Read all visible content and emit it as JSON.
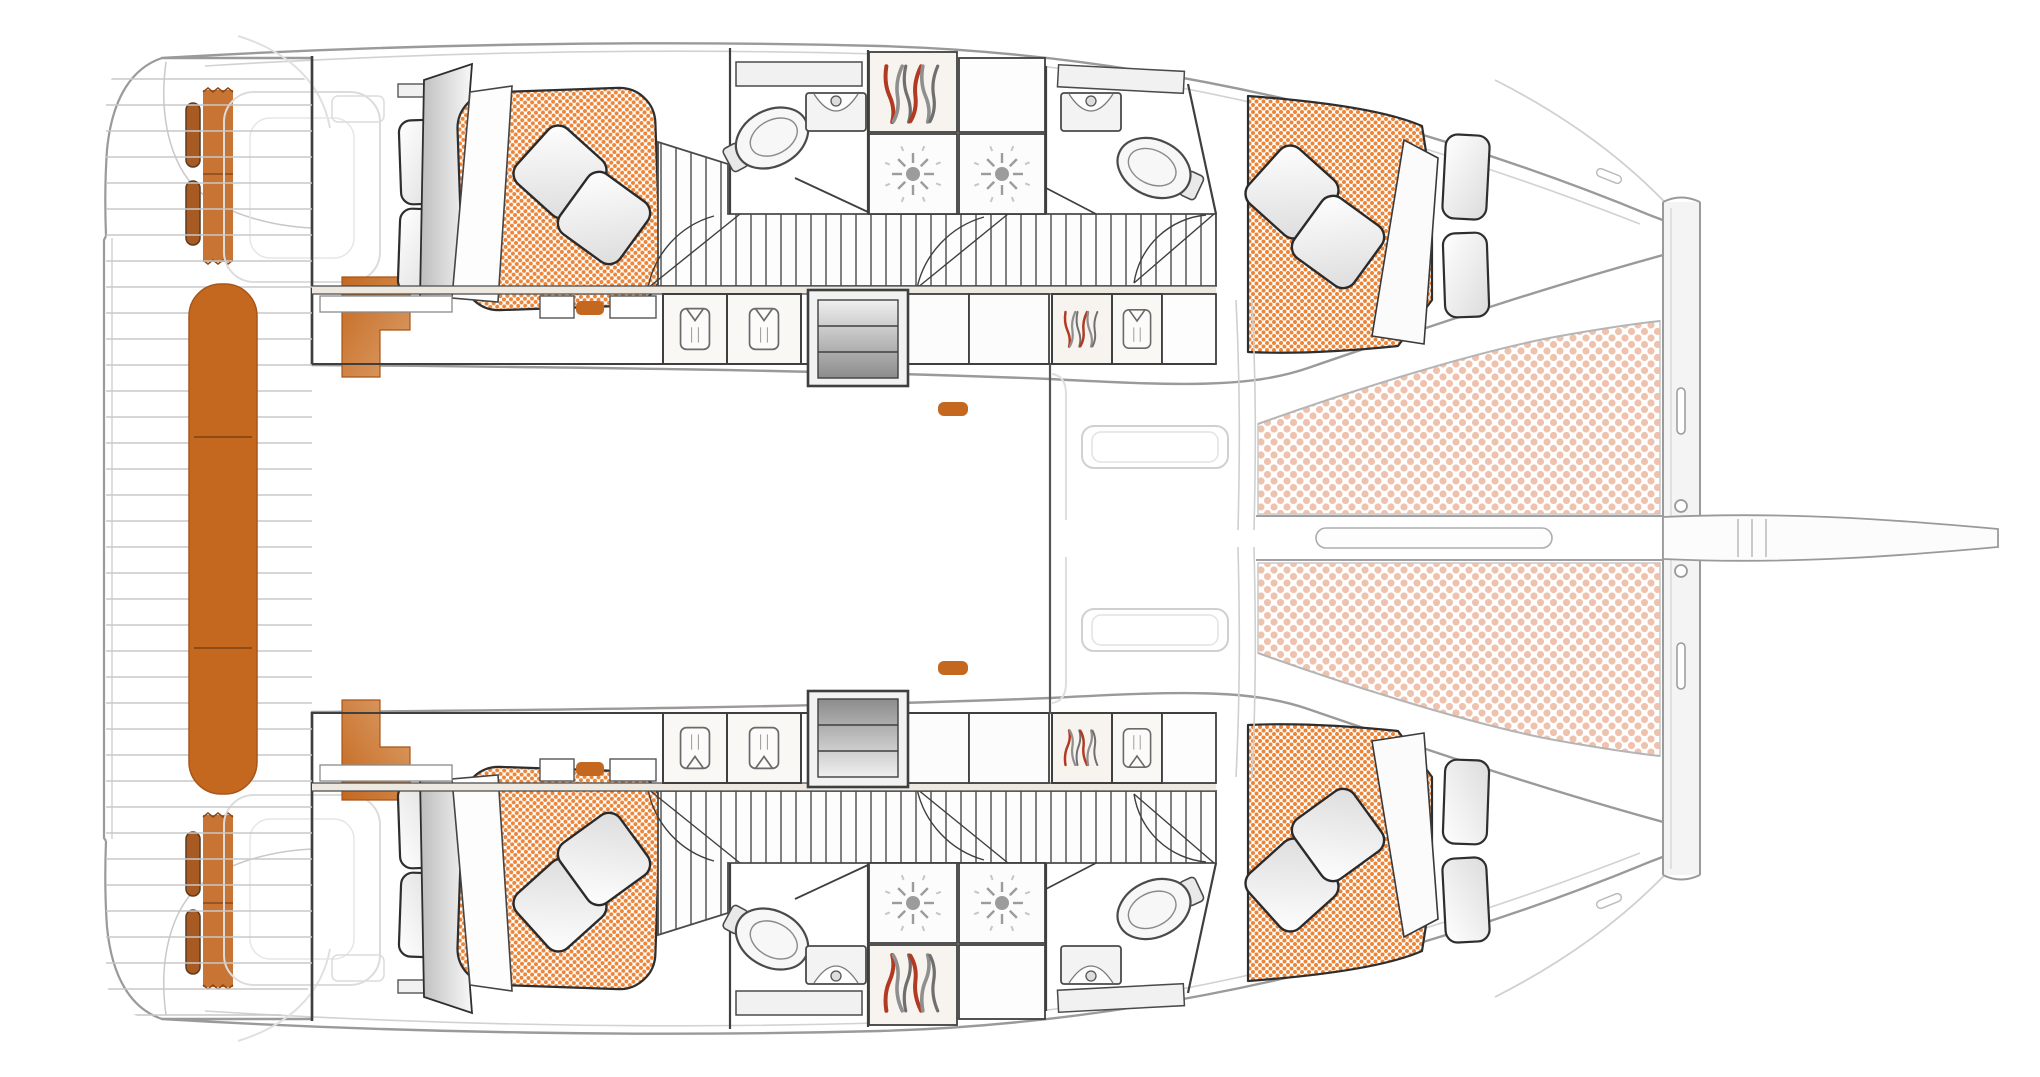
{
  "figure": {
    "label": "Sailing catamaran accommodation layout — overhead floor plan",
    "type": "floorplan",
    "view": "top, bows pointing right"
  },
  "colors": {
    "hull_outline": "#9a9a9a",
    "deck_inner": "#d2d2d2",
    "wall": "#3f3f3f",
    "faint": "#d9d9d9",
    "seat_orange": "#c4681f",
    "seat_orange_light": "#dca06b",
    "seat_orange_edge": "#a8551a",
    "strap_orange": "#c87434",
    "cushion_brown": "#a85a23",
    "mattress_dot": "#ec8538",
    "trampoline_dot": "#efc2ae",
    "hanger_red": "#b23a22",
    "hanger_gray": "#8f8f8f",
    "stair_dark": "#8c8c8c",
    "stair_light": "#efefef",
    "wood": "#f7f4ef",
    "wood_band": "#ede9e1",
    "corridor_slat": "#4a4a4a",
    "deck_slat": "#c8c8c8"
  },
  "areas": {
    "cockpit": {
      "label": "Aft cockpit with transom bench, corner seats and helm straps"
    },
    "swim_platforms": {
      "label": "Twin transom swim platforms with slatted steps"
    },
    "saloon": {
      "label": "Bridgedeck saloon (shown unfurnished)"
    },
    "port_hull": {
      "label": "Port hull: aft double cabin, aft head, wardrobe, two shower stalls, forward head, forward double cabin"
    },
    "starboard_hull": {
      "label": "Starboard hull: mirror arrangement of port hull"
    },
    "foredeck": {
      "label": "Foredeck with deck hatches"
    },
    "trampoline": {
      "label": "Bow trampoline nets"
    },
    "crossbeam": {
      "label": "Forward crossbeam"
    },
    "bowsprit": {
      "label": "Bowsprit and anchor sprit on centreline"
    },
    "companionways": {
      "label": "Companionway steps from saloon down into each hull"
    }
  },
  "inventory": {
    "double_berths": 4,
    "toilets": 4,
    "sinks": 4,
    "shower_stalls": 4,
    "hanging_wardrobes": 4,
    "companionway_stairs": 2,
    "deck_hatches": 2,
    "trampoline_panels": 2
  }
}
